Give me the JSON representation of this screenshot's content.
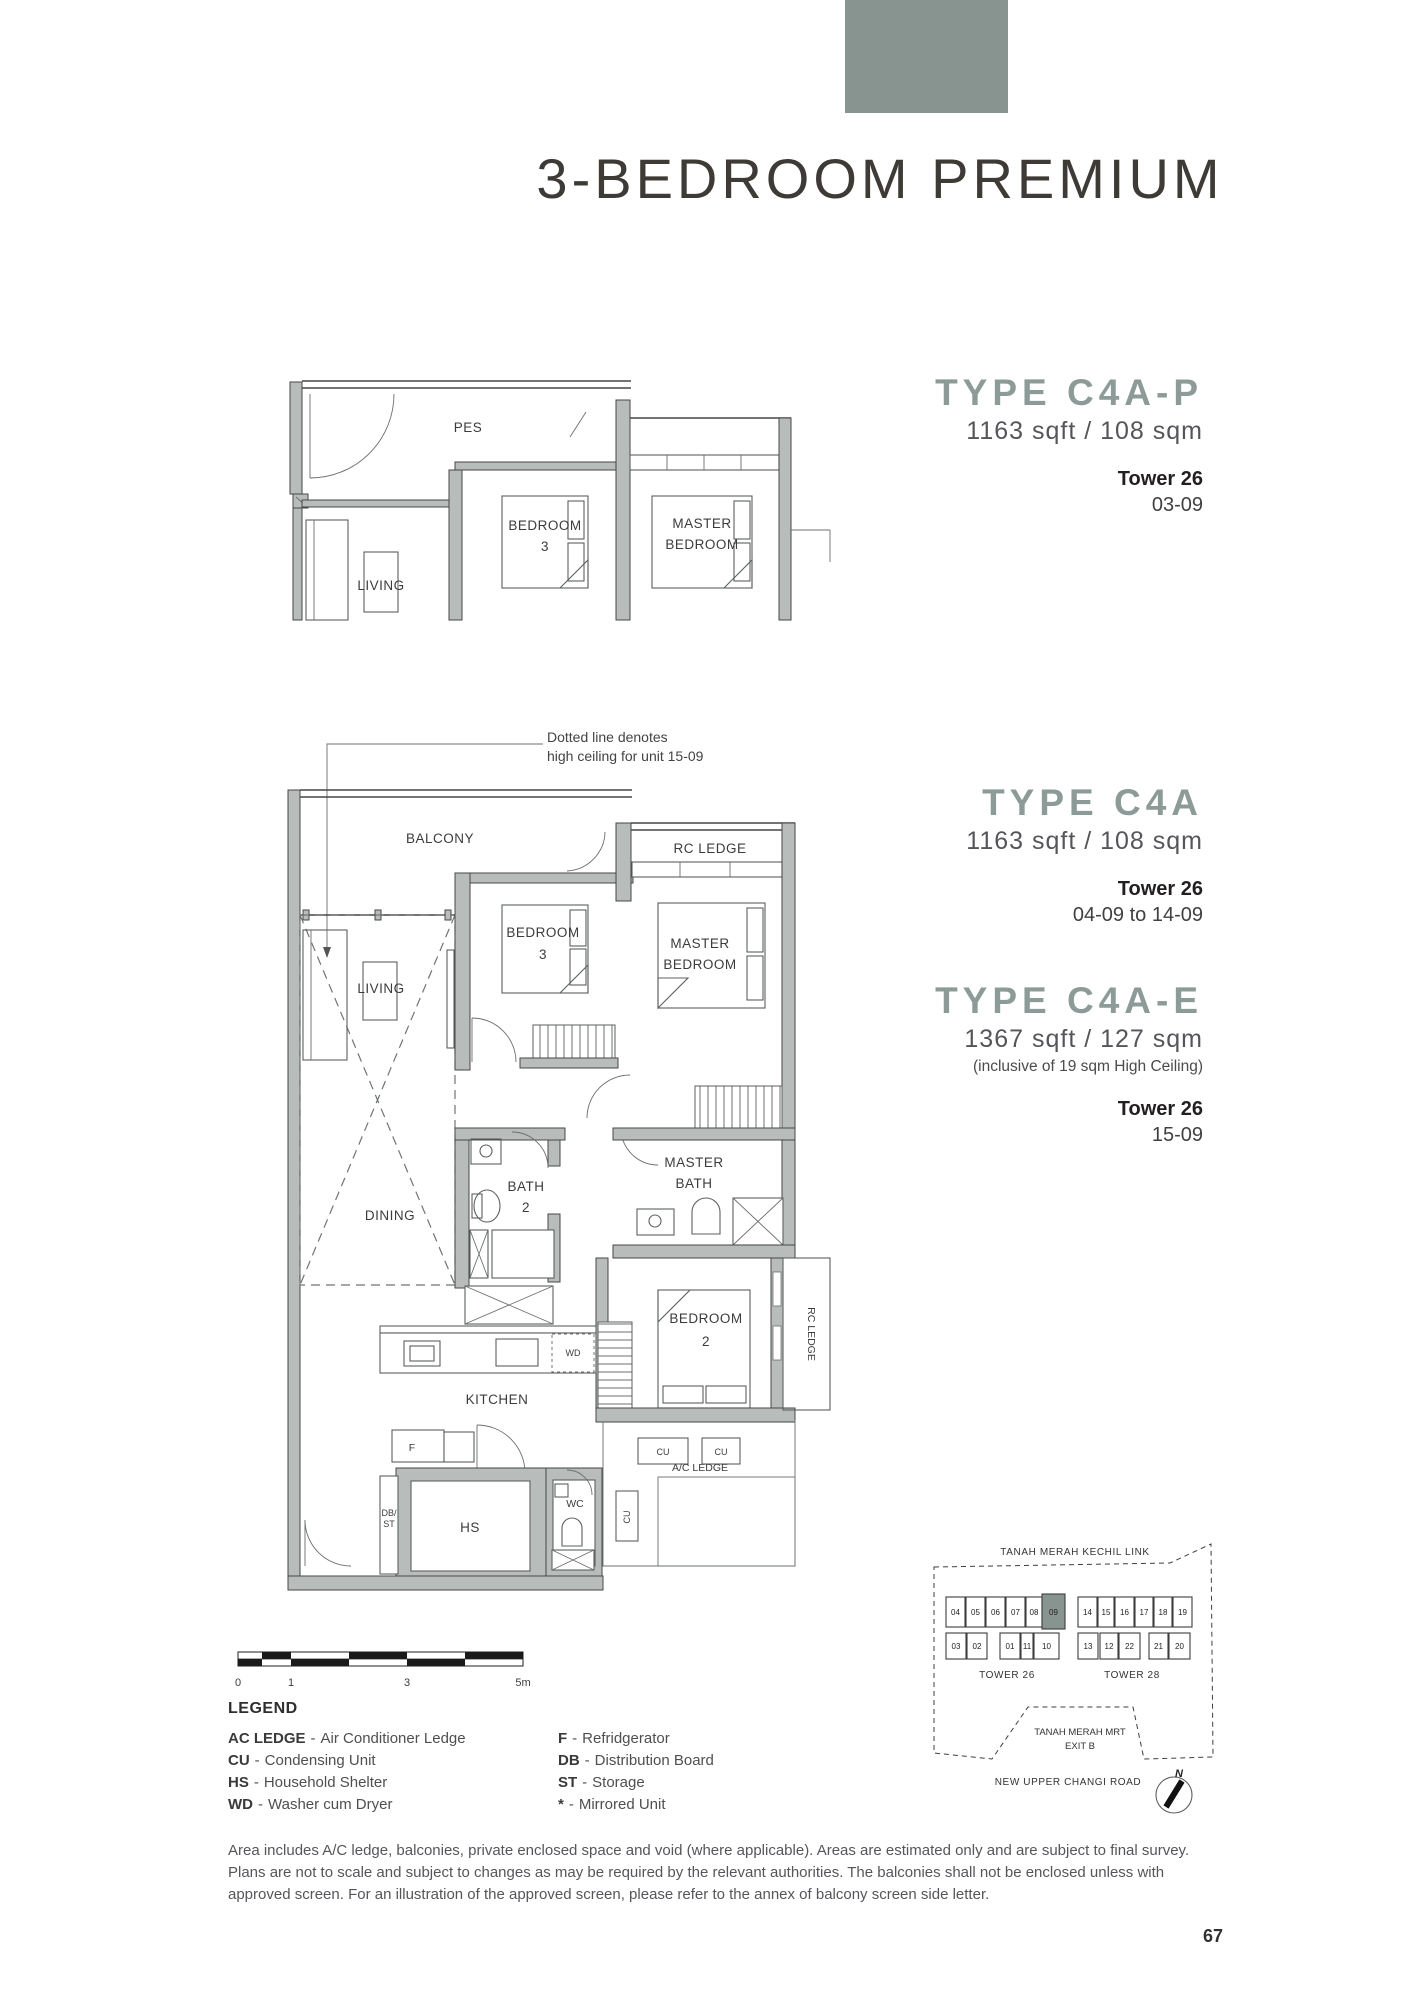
{
  "page": {
    "title": "3-BEDROOM PREMIUM",
    "page_number": "67"
  },
  "theme": {
    "accent": "#87948f",
    "heading": "#8c9b97"
  },
  "types": [
    {
      "name": "TYPE C4A-P",
      "area": "1163 sqft / 108 sqm",
      "tower": "Tower 26",
      "units": "03-09"
    },
    {
      "name": "TYPE C4A",
      "area": "1163 sqft / 108 sqm",
      "tower": "Tower 26",
      "units": "04-09 to 14-09"
    },
    {
      "name": "TYPE C4A-E",
      "area": "1367 sqft / 127 sqm",
      "note": "(inclusive of 19 sqm High Ceiling)",
      "tower": "Tower 26",
      "units": "15-09"
    }
  ],
  "annotation": "Dotted line denotes\nhigh ceiling for unit 15-09",
  "plan_top": {
    "pes": "PES",
    "living": "LIVING",
    "bedroom3": [
      "BEDROOM",
      "3"
    ],
    "master_bedroom": [
      "MASTER",
      "BEDROOM"
    ]
  },
  "plan_main": {
    "balcony": "BALCONY",
    "rc_ledge_top": "RC LEDGE",
    "living": "LIVING",
    "bedroom3": [
      "BEDROOM",
      "3"
    ],
    "master_bedroom": [
      "MASTER",
      "BEDROOM"
    ],
    "dining": "DINING",
    "bath2": [
      "BATH",
      "2"
    ],
    "master_bath": [
      "MASTER",
      "BATH"
    ],
    "bedroom2": [
      "BEDROOM",
      "2"
    ],
    "rc_ledge_side": "RC LEDGE",
    "kitchen": "KITCHEN",
    "wd": "WD",
    "fridge": "F",
    "db_st": [
      "DB/",
      "ST"
    ],
    "hs": "HS",
    "wc": "WC",
    "ac_ledge": "A/C LEDGE",
    "cu": "CU"
  },
  "scale_bar": {
    "ticks": [
      "0",
      "1",
      "3",
      "5m"
    ]
  },
  "key_plan": {
    "road_top": "TANAH MERAH KECHIL LINK",
    "mrt": [
      "TANAH MERAH MRT",
      "EXIT B"
    ],
    "road_bottom": "NEW UPPER CHANGI ROAD",
    "north": "N",
    "tower26": {
      "label": "TOWER 26",
      "top": [
        "04",
        "05",
        "06",
        "07",
        "08",
        "09"
      ],
      "bottom": [
        "03",
        "02",
        "01",
        "11",
        "10"
      ],
      "highlighted": "09"
    },
    "tower28": {
      "label": "TOWER 28",
      "top": [
        "14",
        "15",
        "16",
        "17",
        "18",
        "19"
      ],
      "bottom": [
        "13",
        "12",
        "22",
        "21",
        "20"
      ]
    }
  },
  "legend": {
    "title": "LEGEND",
    "sep": "-",
    "left": [
      {
        "abbr": "AC LEDGE",
        "desc": "Air Conditioner Ledge"
      },
      {
        "abbr": "CU",
        "desc": "Condensing Unit"
      },
      {
        "abbr": "HS",
        "desc": "Household Shelter"
      },
      {
        "abbr": "WD",
        "desc": "Washer cum Dryer"
      }
    ],
    "right": [
      {
        "abbr": "F",
        "desc": "Refridgerator"
      },
      {
        "abbr": "DB",
        "desc": "Distribution Board"
      },
      {
        "abbr": "ST",
        "desc": "Storage"
      },
      {
        "abbr": "*",
        "desc": "Mirrored Unit"
      }
    ]
  },
  "disclaimer": "Area includes A/C ledge, balconies, private enclosed space and void (where applicable). Areas are estimated only and are subject to final survey.\nPlans are not to scale and subject to changes as may be required by the relevant authorities. The balconies shall not be enclosed unless with\napproved screen. For an illustration of the approved screen, please refer to the annex of balcony screen side letter."
}
